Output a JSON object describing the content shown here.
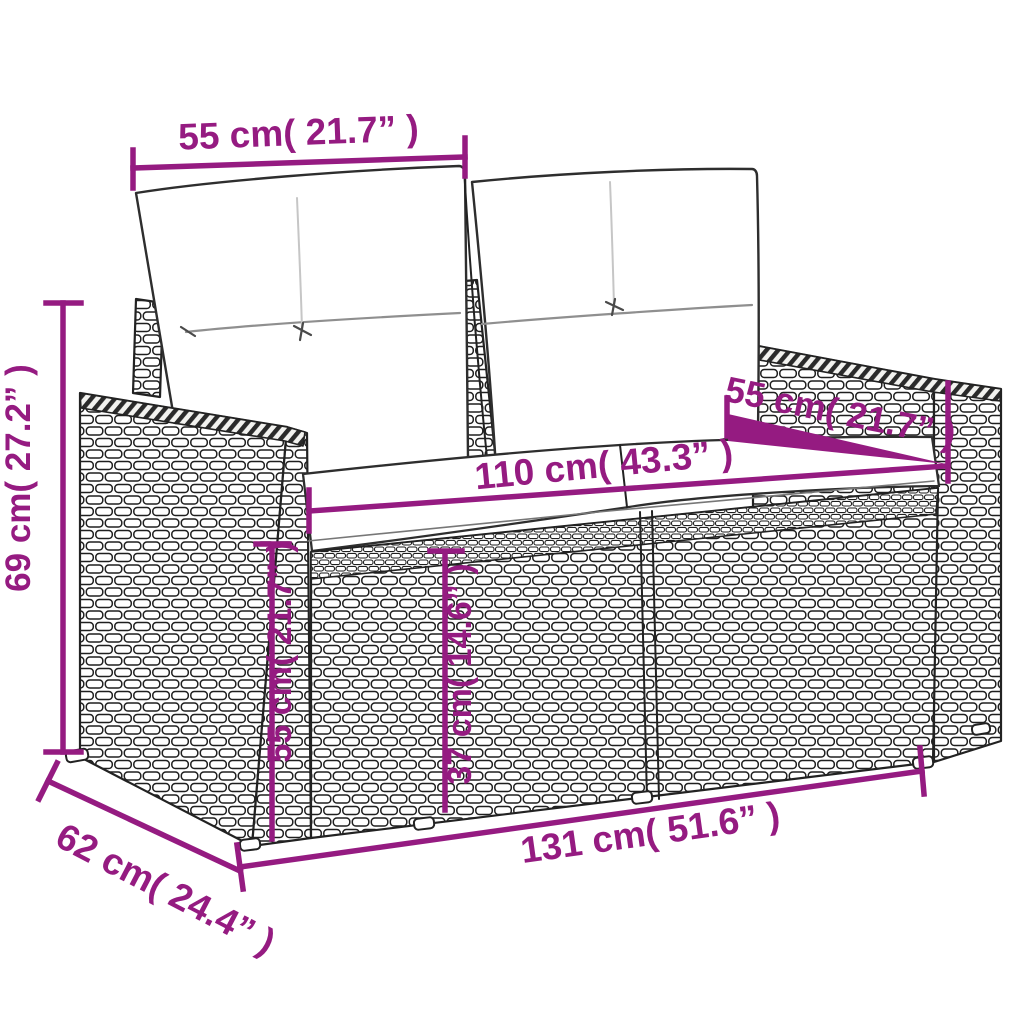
{
  "style": {
    "dimension_color": "#951b81",
    "outline_color": "#222222",
    "background": "#ffffff"
  },
  "diagram": {
    "subject": "poly-rattan-garden-loveseat-with-cushions",
    "dimensions": {
      "back_cushion_width": {
        "label": "55 cm( 21.7” )",
        "cm": 55,
        "inch": 21.7
      },
      "total_height": {
        "label": "69 cm( 27.2” )",
        "cm": 69,
        "inch": 27.2
      },
      "seat_width": {
        "label": "110 cm( 43.3” )",
        "cm": 110,
        "inch": 43.3
      },
      "armrest_depth": {
        "label": "55 cm( 21.7” )",
        "cm": 55,
        "inch": 21.7
      },
      "armrest_height": {
        "label": "55 cm( 21.7” )",
        "cm": 55,
        "inch": 21.7
      },
      "seat_height": {
        "label": "37 cm( 14.6” )",
        "cm": 37,
        "inch": 14.6
      },
      "total_width": {
        "label": "131 cm( 51.6” )",
        "cm": 131,
        "inch": 51.6
      },
      "total_depth": {
        "label": "62 cm( 24.4” )",
        "cm": 62,
        "inch": 24.4
      }
    }
  }
}
